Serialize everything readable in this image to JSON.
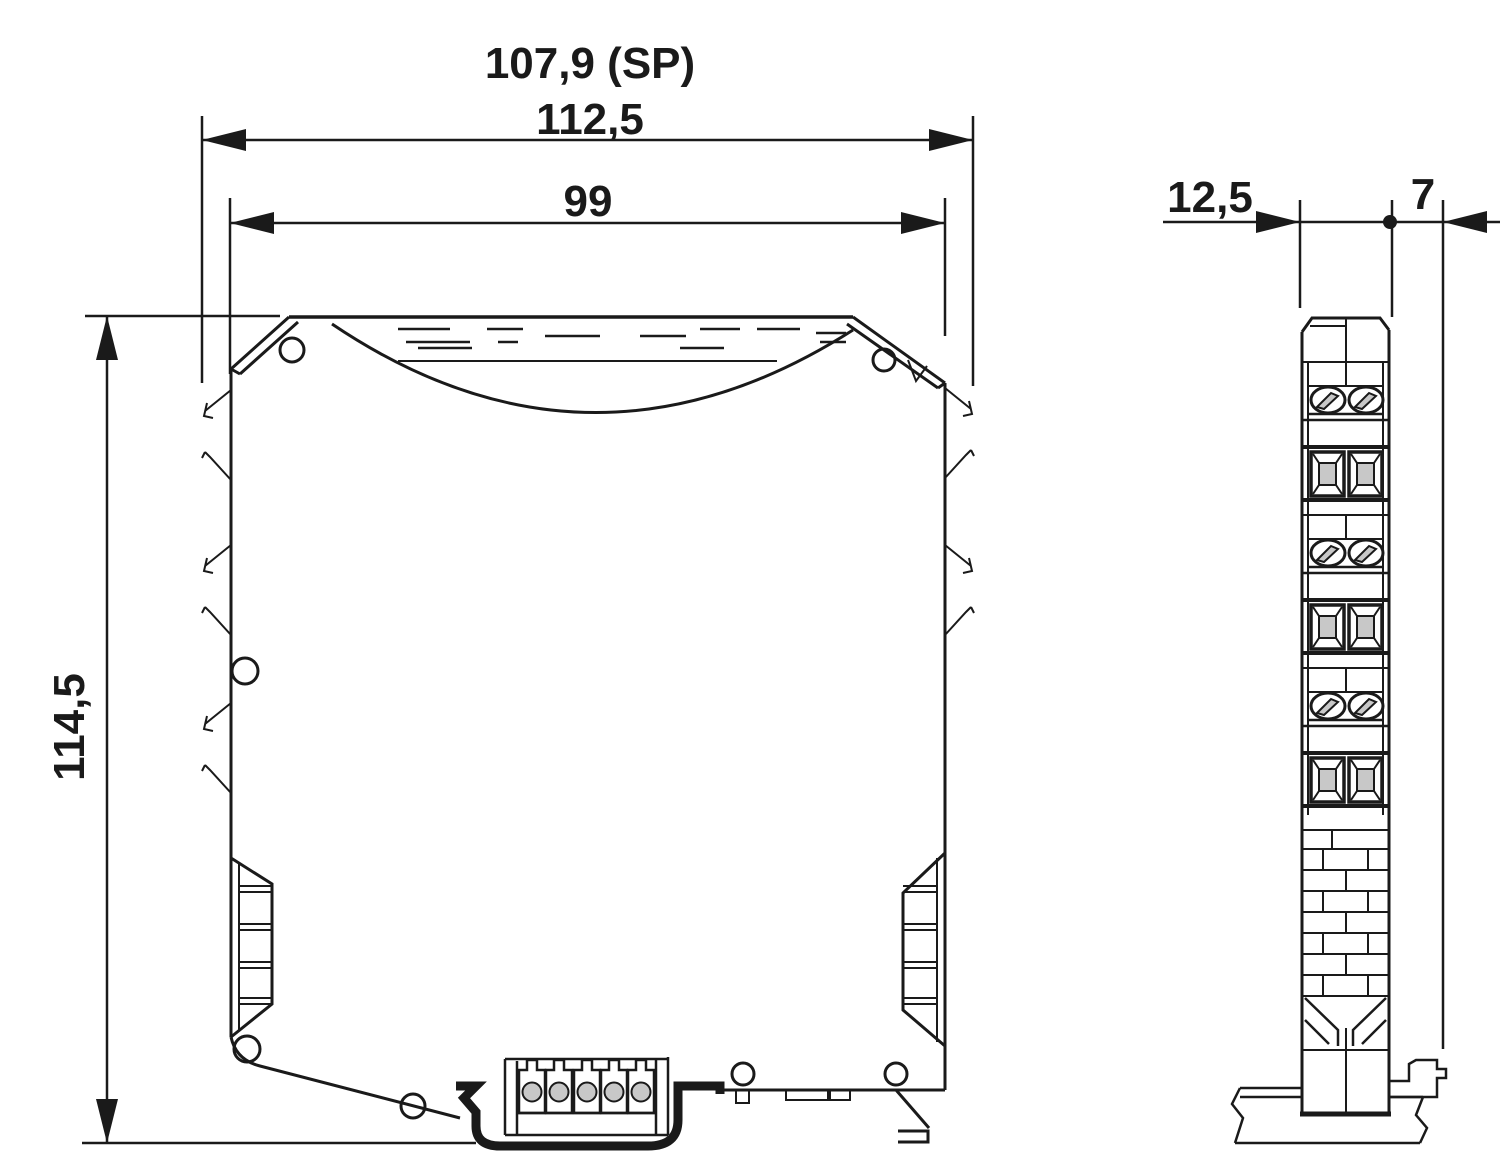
{
  "front_view": {
    "dim_shoulder_width": "107,9 (SP)",
    "dim_overall_width": "112,5",
    "dim_housing_width": "99",
    "dim_height": "114,5"
  },
  "side_view": {
    "dim_module_width": "12,5",
    "dim_latch_depth": "7"
  },
  "colors": {
    "line": "#1a1a1a",
    "background": "#ffffff",
    "shade": "#c8c8c8"
  }
}
